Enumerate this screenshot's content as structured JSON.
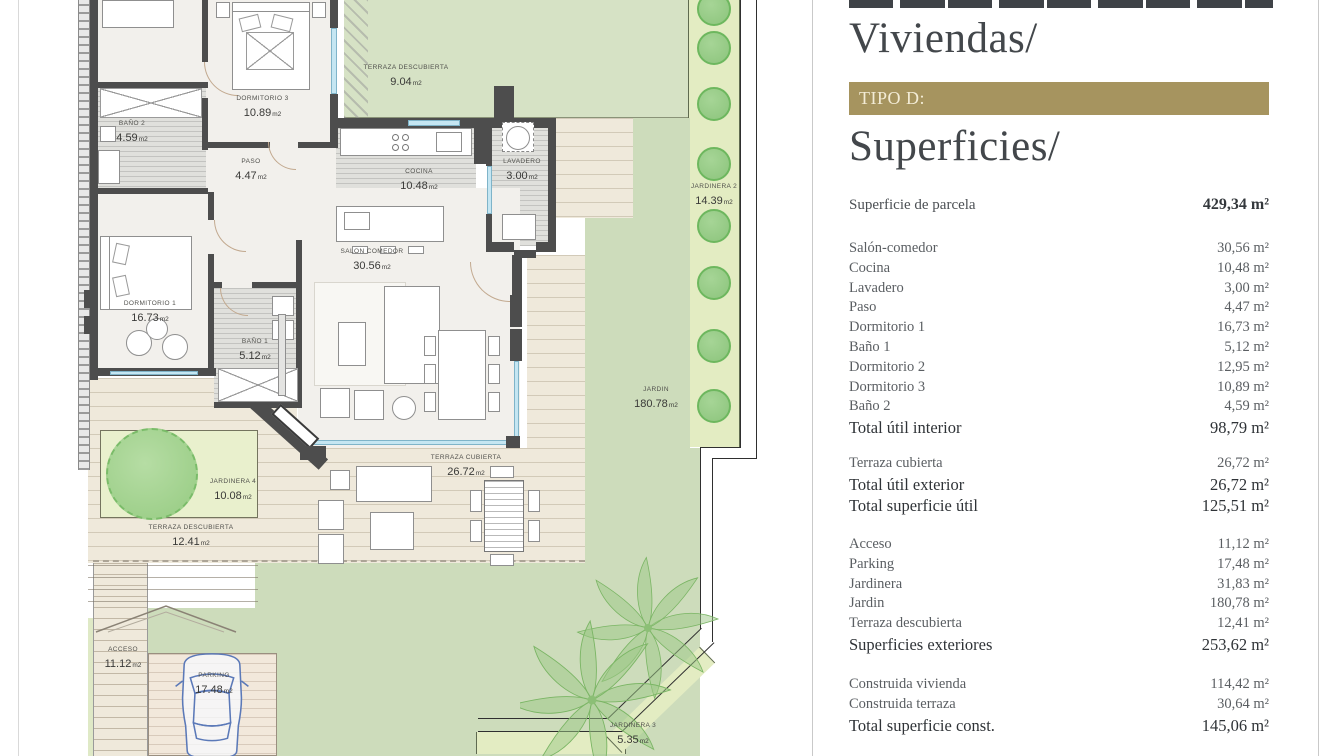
{
  "colors": {
    "gold": "#a6945f",
    "panel_heading": "#43474b",
    "panel_text": "#5a5e62",
    "garden_green": "#cddcbb",
    "plan_wall": "#4d4d4d",
    "glass_blue": "#c5e6f2"
  },
  "panel": {
    "title_viviendas": "Viviendas/",
    "tipo_label": "TIPO D:",
    "title_superficies": "Superficies/",
    "parcela": {
      "label": "Superficie de parcela",
      "value": "429,34 m²"
    },
    "sections": [
      {
        "rows": [
          {
            "label": "Salón-comedor",
            "value": "30,56 m²"
          },
          {
            "label": "Cocina",
            "value": "10,48 m²"
          },
          {
            "label": "Lavadero",
            "value": "3,00 m²"
          },
          {
            "label": "Paso",
            "value": "4,47 m²"
          },
          {
            "label": "Dormitorio 1",
            "value": "16,73 m²"
          },
          {
            "label": "Baño 1",
            "value": "5,12 m²"
          },
          {
            "label": "Dormitorio 2",
            "value": "12,95 m²"
          },
          {
            "label": "Dormitorio 3",
            "value": "10,89 m²"
          },
          {
            "label": "Baño 2",
            "value": "4,59 m²"
          },
          {
            "label": "Total útil interior",
            "value": "98,79 m²",
            "strong": true
          }
        ]
      },
      {
        "rows": [
          {
            "label": "Terraza cubierta",
            "value": "26,72 m²"
          },
          {
            "label": "Total útil exterior",
            "value": "26,72 m²",
            "strong": true
          },
          {
            "label": "Total superficie útil",
            "value": "125,51 m²",
            "strong": true
          }
        ]
      },
      {
        "rows": [
          {
            "label": "Acceso",
            "value": "11,12 m²"
          },
          {
            "label": "Parking",
            "value": "17,48 m²"
          },
          {
            "label": "Jardinera",
            "value": "31,83 m²"
          },
          {
            "label": "Jardin",
            "value": "180,78 m²"
          },
          {
            "label": "Terraza descubierta",
            "value": "12,41 m²"
          },
          {
            "label": "Superficies exteriores",
            "value": "253,62 m²",
            "strong": true
          }
        ]
      },
      {
        "rows": [
          {
            "label": "Construida vivienda",
            "value": "114,42 m²"
          },
          {
            "label": "Construida terraza",
            "value": "30,64 m²"
          },
          {
            "label": "Total superficie const.",
            "value": "145,06 m²",
            "strong": true
          }
        ]
      }
    ]
  },
  "plan": {
    "unit": "m2",
    "labels": [
      {
        "id": "d3",
        "name": "DORMITORIO 3",
        "area": "10.89"
      },
      {
        "id": "b2",
        "name": "BAÑO 2",
        "area": "4.59"
      },
      {
        "id": "paso",
        "name": "PASO",
        "area": "4.47"
      },
      {
        "id": "cocina",
        "name": "COCINA",
        "area": "10.48"
      },
      {
        "id": "lav",
        "name": "LAVADERO",
        "area": "3.00"
      },
      {
        "id": "td9",
        "name": "TERRAZA DESCUBIERTA",
        "area": "9.04"
      },
      {
        "id": "j2",
        "name": "JARDINERA 2",
        "area": "14.39"
      },
      {
        "id": "salon",
        "name": "SALON COMEDOR",
        "area": "30.56"
      },
      {
        "id": "d1",
        "name": "DORMITORIO 1",
        "area": "16.73"
      },
      {
        "id": "b1",
        "name": "BAÑO 1",
        "area": "5.12"
      },
      {
        "id": "jardin",
        "name": "JARDIN",
        "area": "180.78"
      },
      {
        "id": "j4",
        "name": "JARDINERA 4",
        "area": "10.08"
      },
      {
        "id": "tc",
        "name": "TERRAZA CUBIERTA",
        "area": "26.72"
      },
      {
        "id": "td12",
        "name": "TERRAZA DESCUBIERTA",
        "area": "12.41"
      },
      {
        "id": "acc",
        "name": "ACCESO",
        "area": "11.12"
      },
      {
        "id": "park",
        "name": "PARKING",
        "area": "17.48"
      },
      {
        "id": "j3",
        "name": "JARDINERA 3",
        "area": "5.35"
      }
    ]
  }
}
